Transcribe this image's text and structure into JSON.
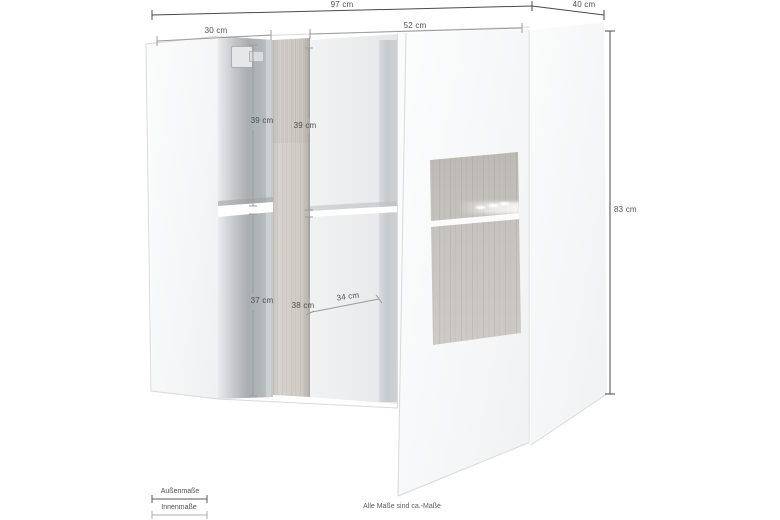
{
  "diagram": {
    "measurements": {
      "outer_width": "97 cm",
      "outer_depth": "40 cm",
      "outer_height": "83 cm",
      "left_section_width": "30 cm",
      "right_section_width": "52 cm",
      "left_upper_height": "39 cm",
      "center_upper_height": "39 cm",
      "left_lower_height": "37 cm",
      "center_lower_height": "38 cm",
      "inner_depth": "34 cm"
    },
    "legend": {
      "outer_label": "Außenmaße",
      "inner_label": "Innenmaße"
    },
    "note": "Alle Maße sind ca.-Maße",
    "colors": {
      "outer_line": "#4a4a4a",
      "inner_line": "#9b9b9b",
      "wood": "#d2cec7",
      "interior_shadow": "#aab0b3"
    }
  }
}
